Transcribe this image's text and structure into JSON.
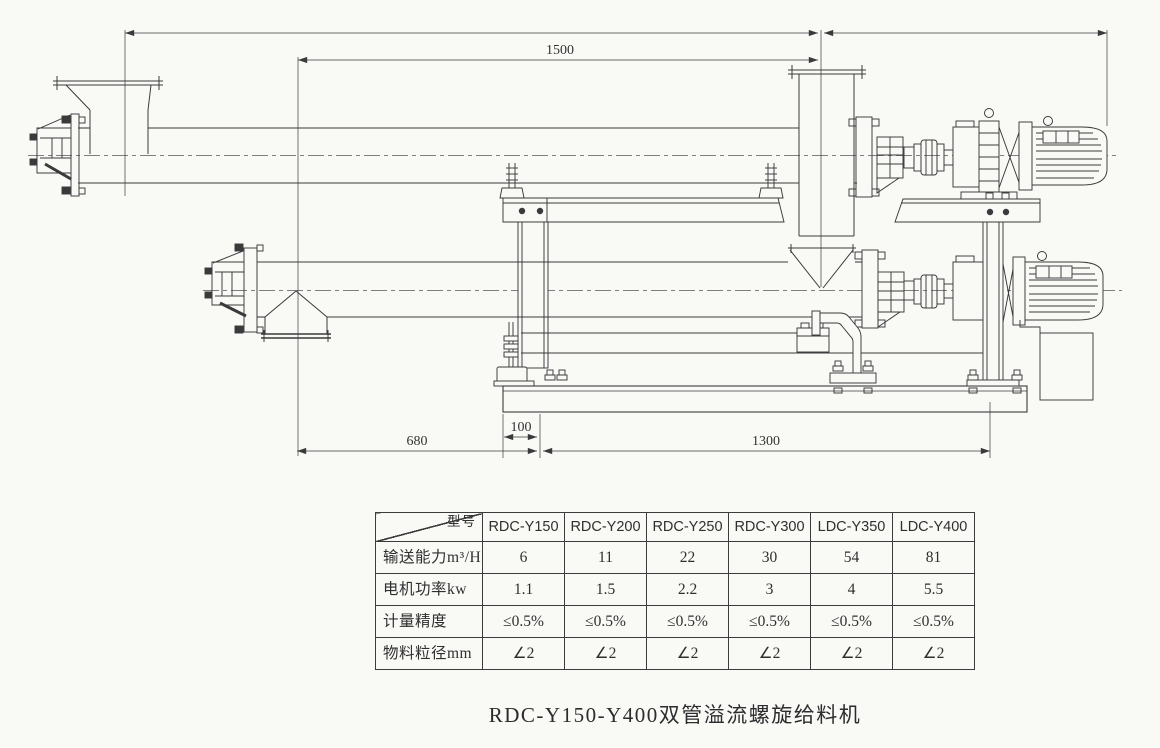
{
  "page": {
    "paper_color": "#f9f9f6",
    "ink_color": "#3a3a3c"
  },
  "drawing": {
    "title_hint": "dual screw feeder general arrangement",
    "dimensions": {
      "top_span": "1500",
      "bottom_left": "680",
      "bottom_mid": "100",
      "bottom_right": "1300"
    }
  },
  "table": {
    "corner_label": "型号",
    "columns": [
      "RDC-Y150",
      "RDC-Y200",
      "RDC-Y250",
      "RDC-Y300",
      "LDC-Y350",
      "LDC-Y400"
    ],
    "rows": [
      {
        "label": "输送能力m³/H",
        "values": [
          "6",
          "11",
          "22",
          "30",
          "54",
          "81"
        ]
      },
      {
        "label": "电机功率kw",
        "values": [
          "1.1",
          "1.5",
          "2.2",
          "3",
          "4",
          "5.5"
        ]
      },
      {
        "label": "计量精度",
        "values": [
          "≤0.5%",
          "≤0.5%",
          "≤0.5%",
          "≤0.5%",
          "≤0.5%",
          "≤0.5%"
        ]
      },
      {
        "label": "物料粒径mm",
        "values": [
          "∠2",
          "∠2",
          "∠2",
          "∠2",
          "∠2",
          "∠2"
        ]
      }
    ]
  },
  "caption": "RDC-Y150-Y400双管溢流螺旋给料机"
}
